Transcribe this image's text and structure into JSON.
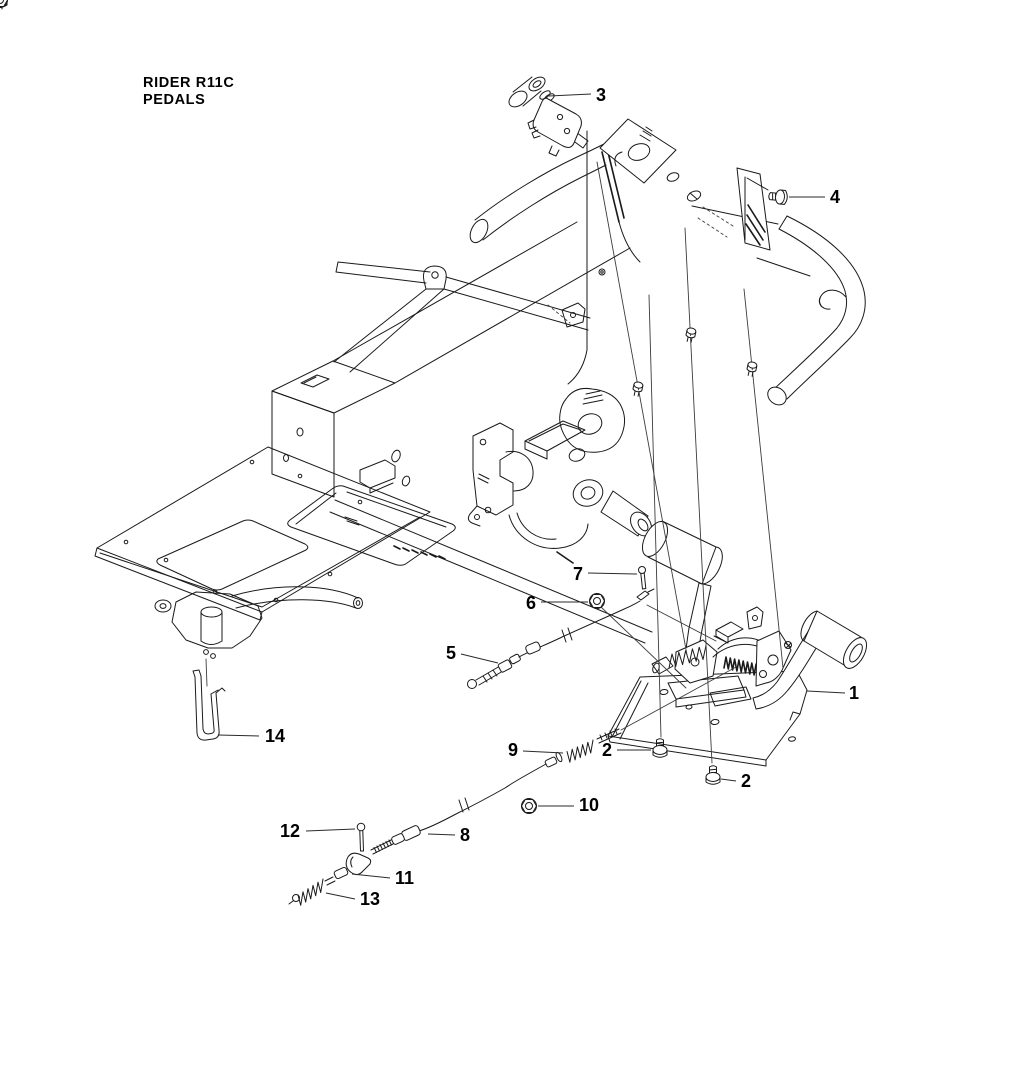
{
  "title": {
    "line1": "RIDER R11C",
    "line2": "PEDALS"
  },
  "drawing": {
    "ink_color": "#1a1a1a",
    "background_color": "#ffffff",
    "callouts": [
      {
        "label": "1"
      },
      {
        "label": "2"
      },
      {
        "label": "2"
      },
      {
        "label": "3"
      },
      {
        "label": "4"
      },
      {
        "label": "5"
      },
      {
        "label": "6"
      },
      {
        "label": "7"
      },
      {
        "label": "8"
      },
      {
        "label": "9"
      },
      {
        "label": "10"
      },
      {
        "label": "11"
      },
      {
        "label": "12"
      },
      {
        "label": "13"
      },
      {
        "label": "14"
      }
    ]
  }
}
